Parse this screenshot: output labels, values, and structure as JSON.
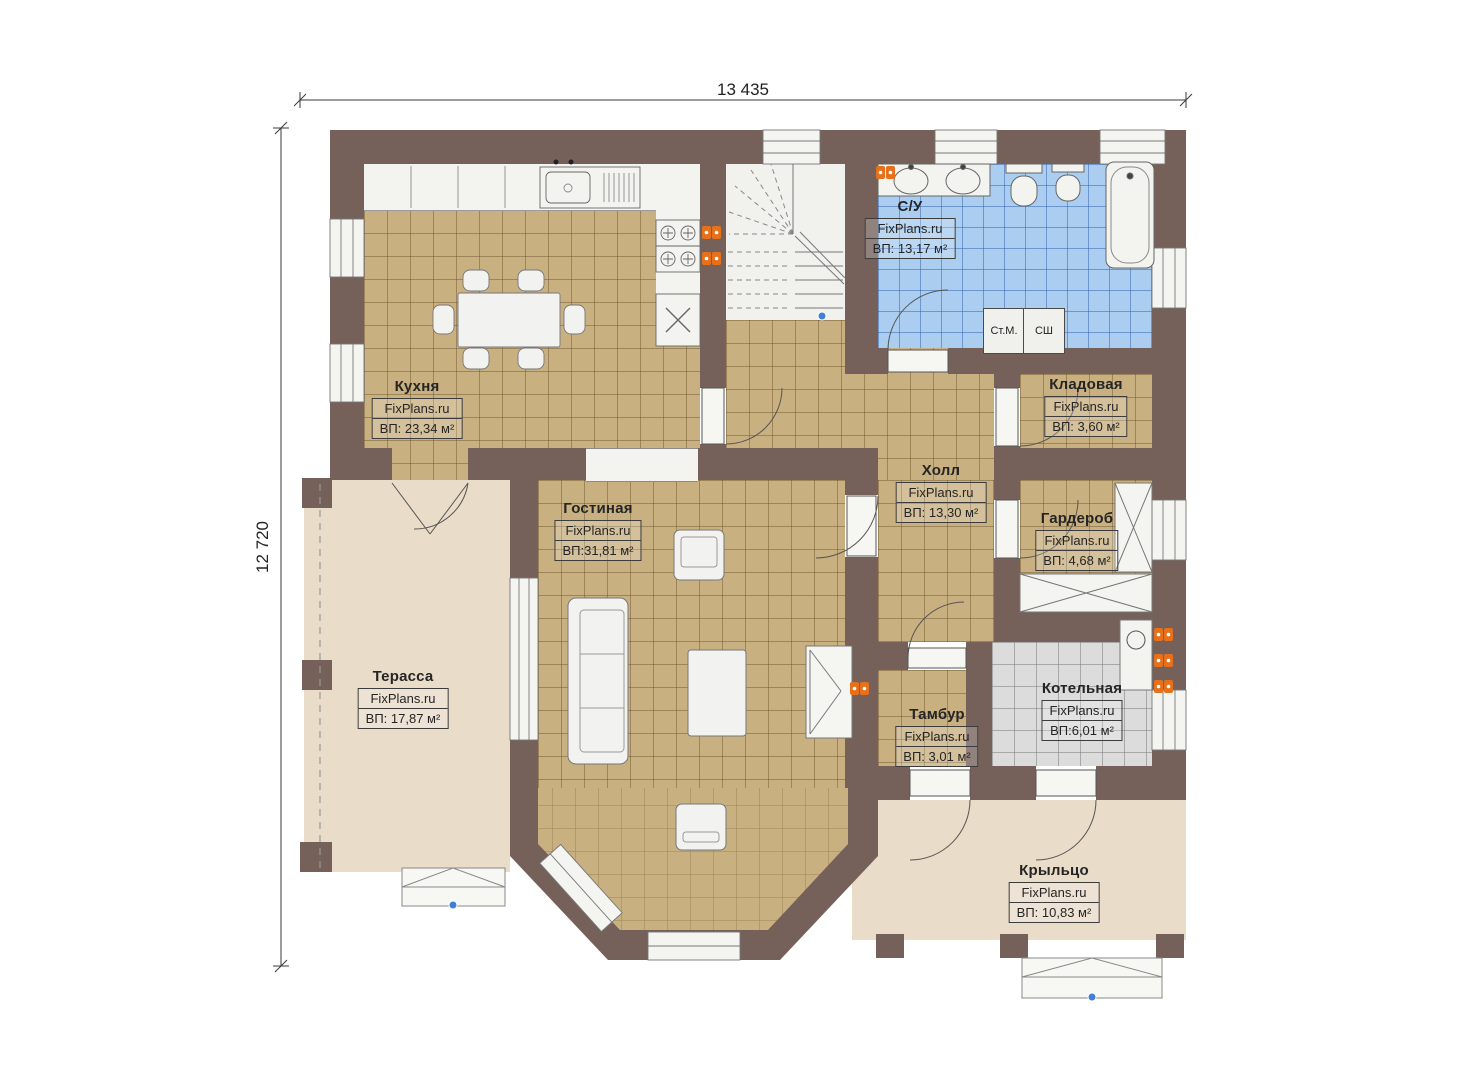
{
  "dimensions": {
    "width_label": "13 435",
    "height_label": "12 720"
  },
  "rooms": [
    {
      "name": "Кухня",
      "watermark": "FixPlans.ru",
      "area": "ВП: 23,34 м²"
    },
    {
      "name": "С/У",
      "watermark": "FixPlans.ru",
      "area": "ВП: 13,17 м²"
    },
    {
      "name": "Кладовая",
      "watermark": "FixPlans.ru",
      "area": "ВП: 3,60 м²"
    },
    {
      "name": "Холл",
      "watermark": "FixPlans.ru",
      "area": "ВП: 13,30 м²"
    },
    {
      "name": "Гардероб",
      "watermark": "FixPlans.ru",
      "area": "ВП: 4,68 м²"
    },
    {
      "name": "Гостиная",
      "watermark": "FixPlans.ru",
      "area": "ВП:31,81 м²"
    },
    {
      "name": "Терасса",
      "watermark": "FixPlans.ru",
      "area": "ВП: 17,87 м²"
    },
    {
      "name": "Тамбур",
      "watermark": "FixPlans.ru",
      "area": "ВП: 3,01 м²"
    },
    {
      "name": "Котельная",
      "watermark": "FixPlans.ru",
      "area": "ВП:6,01 м²"
    },
    {
      "name": "Крыльцо",
      "watermark": "FixPlans.ru",
      "area": "ВП: 10,83 м²"
    }
  ],
  "appliances": {
    "washer_label": "Ст.М.",
    "dryer_label": "СШ"
  },
  "colors": {
    "wall": "#75615a",
    "floor_tile_tan": "#c9b081",
    "floor_tile_blue": "#aacdf0",
    "floor_tile_gray": "#dcdcdc",
    "floor_beige": "#e9dcc8",
    "accent_orange": "#e8701a"
  }
}
